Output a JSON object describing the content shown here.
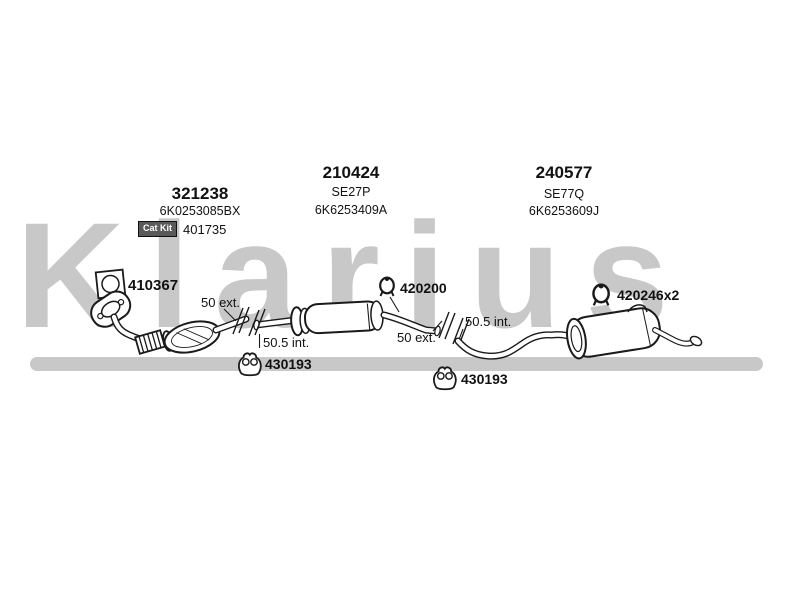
{
  "watermark": {
    "text": "Klarius",
    "color": "#c8c8c8"
  },
  "colors": {
    "background": "#ffffff",
    "line_art": "#1a1a1a",
    "watermark_gray": "#c8c8c8",
    "badge_bg": "#5a5a5a",
    "badge_text": "#ffffff"
  },
  "icons": {
    "gasket": "gasket-icon",
    "clamp": "clamp-icon",
    "hanger": "hanger-icon"
  },
  "parts": {
    "front_pipe": {
      "number": "321238",
      "oe_number": "6K0253085BX",
      "cat_kit": {
        "badge": "Cat Kit",
        "number": "401735"
      }
    },
    "flange_gasket": {
      "number": "410367"
    },
    "centre_silencer": {
      "number": "210424",
      "code": "SE27P",
      "oe_number": "6K6253409A"
    },
    "clamp_centre": {
      "number": "420200"
    },
    "rear_silencer": {
      "number": "240577",
      "code": "SE77Q",
      "oe_number": "6K6253609J"
    },
    "clamp_rear": {
      "number": "420246x2"
    },
    "hanger_front": {
      "number": "430193"
    },
    "hanger_rear": {
      "number": "430193"
    },
    "joint_front": {
      "ext_label": "50 ext.",
      "int_label": "50.5 int."
    },
    "joint_rear": {
      "ext_label": "50 ext.",
      "int_label": "50.5 int."
    }
  }
}
